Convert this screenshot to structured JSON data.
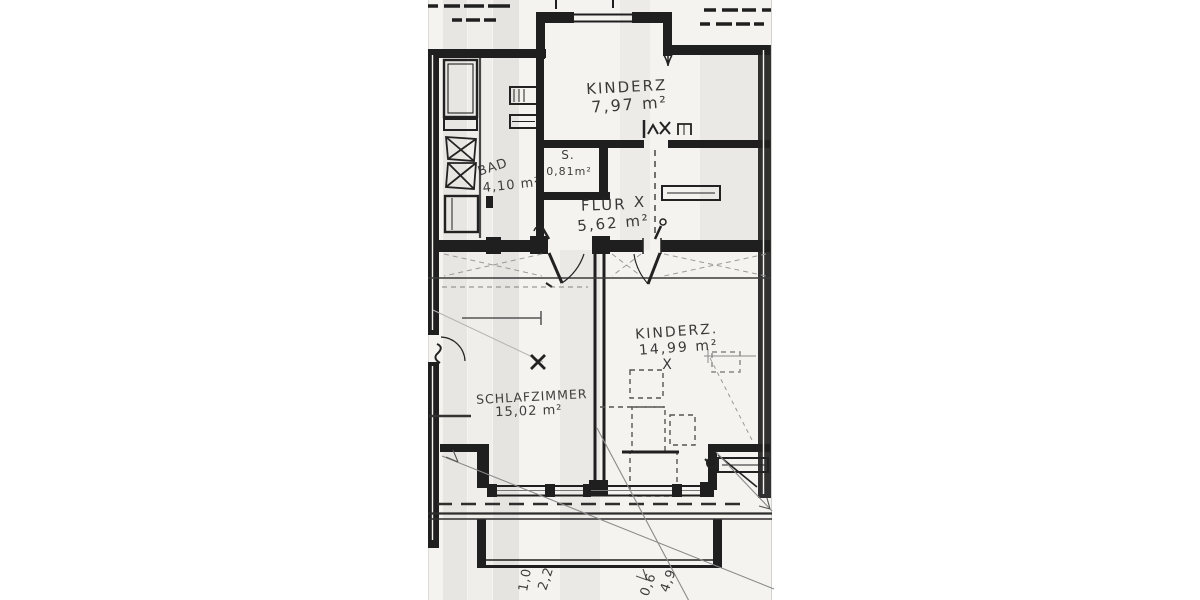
{
  "plan": {
    "rooms": {
      "kinderz_top": {
        "name": "KINDERZ",
        "area": "7,97 m²"
      },
      "closet": {
        "name": "S.",
        "area": "0,81m²"
      },
      "bad": {
        "name": "BAD",
        "area": "4,10 m²"
      },
      "flur": {
        "name": "FLUR",
        "mark": "X",
        "area": "5,62 m²"
      },
      "kinderz_lower": {
        "name": "KINDERZ.",
        "area": "14,99 m²",
        "mark": "X"
      },
      "schlafzimmer": {
        "name": "SCHLAFZIMMER",
        "area": "15,02 m²"
      }
    },
    "dimensions": {
      "bottom_left": [
        "1,0",
        "2,2"
      ],
      "bottom_right": [
        "0,6",
        "4,9"
      ]
    },
    "colors": {
      "ink": "#1f1f1f",
      "paper": "#f4f3ef"
    }
  }
}
